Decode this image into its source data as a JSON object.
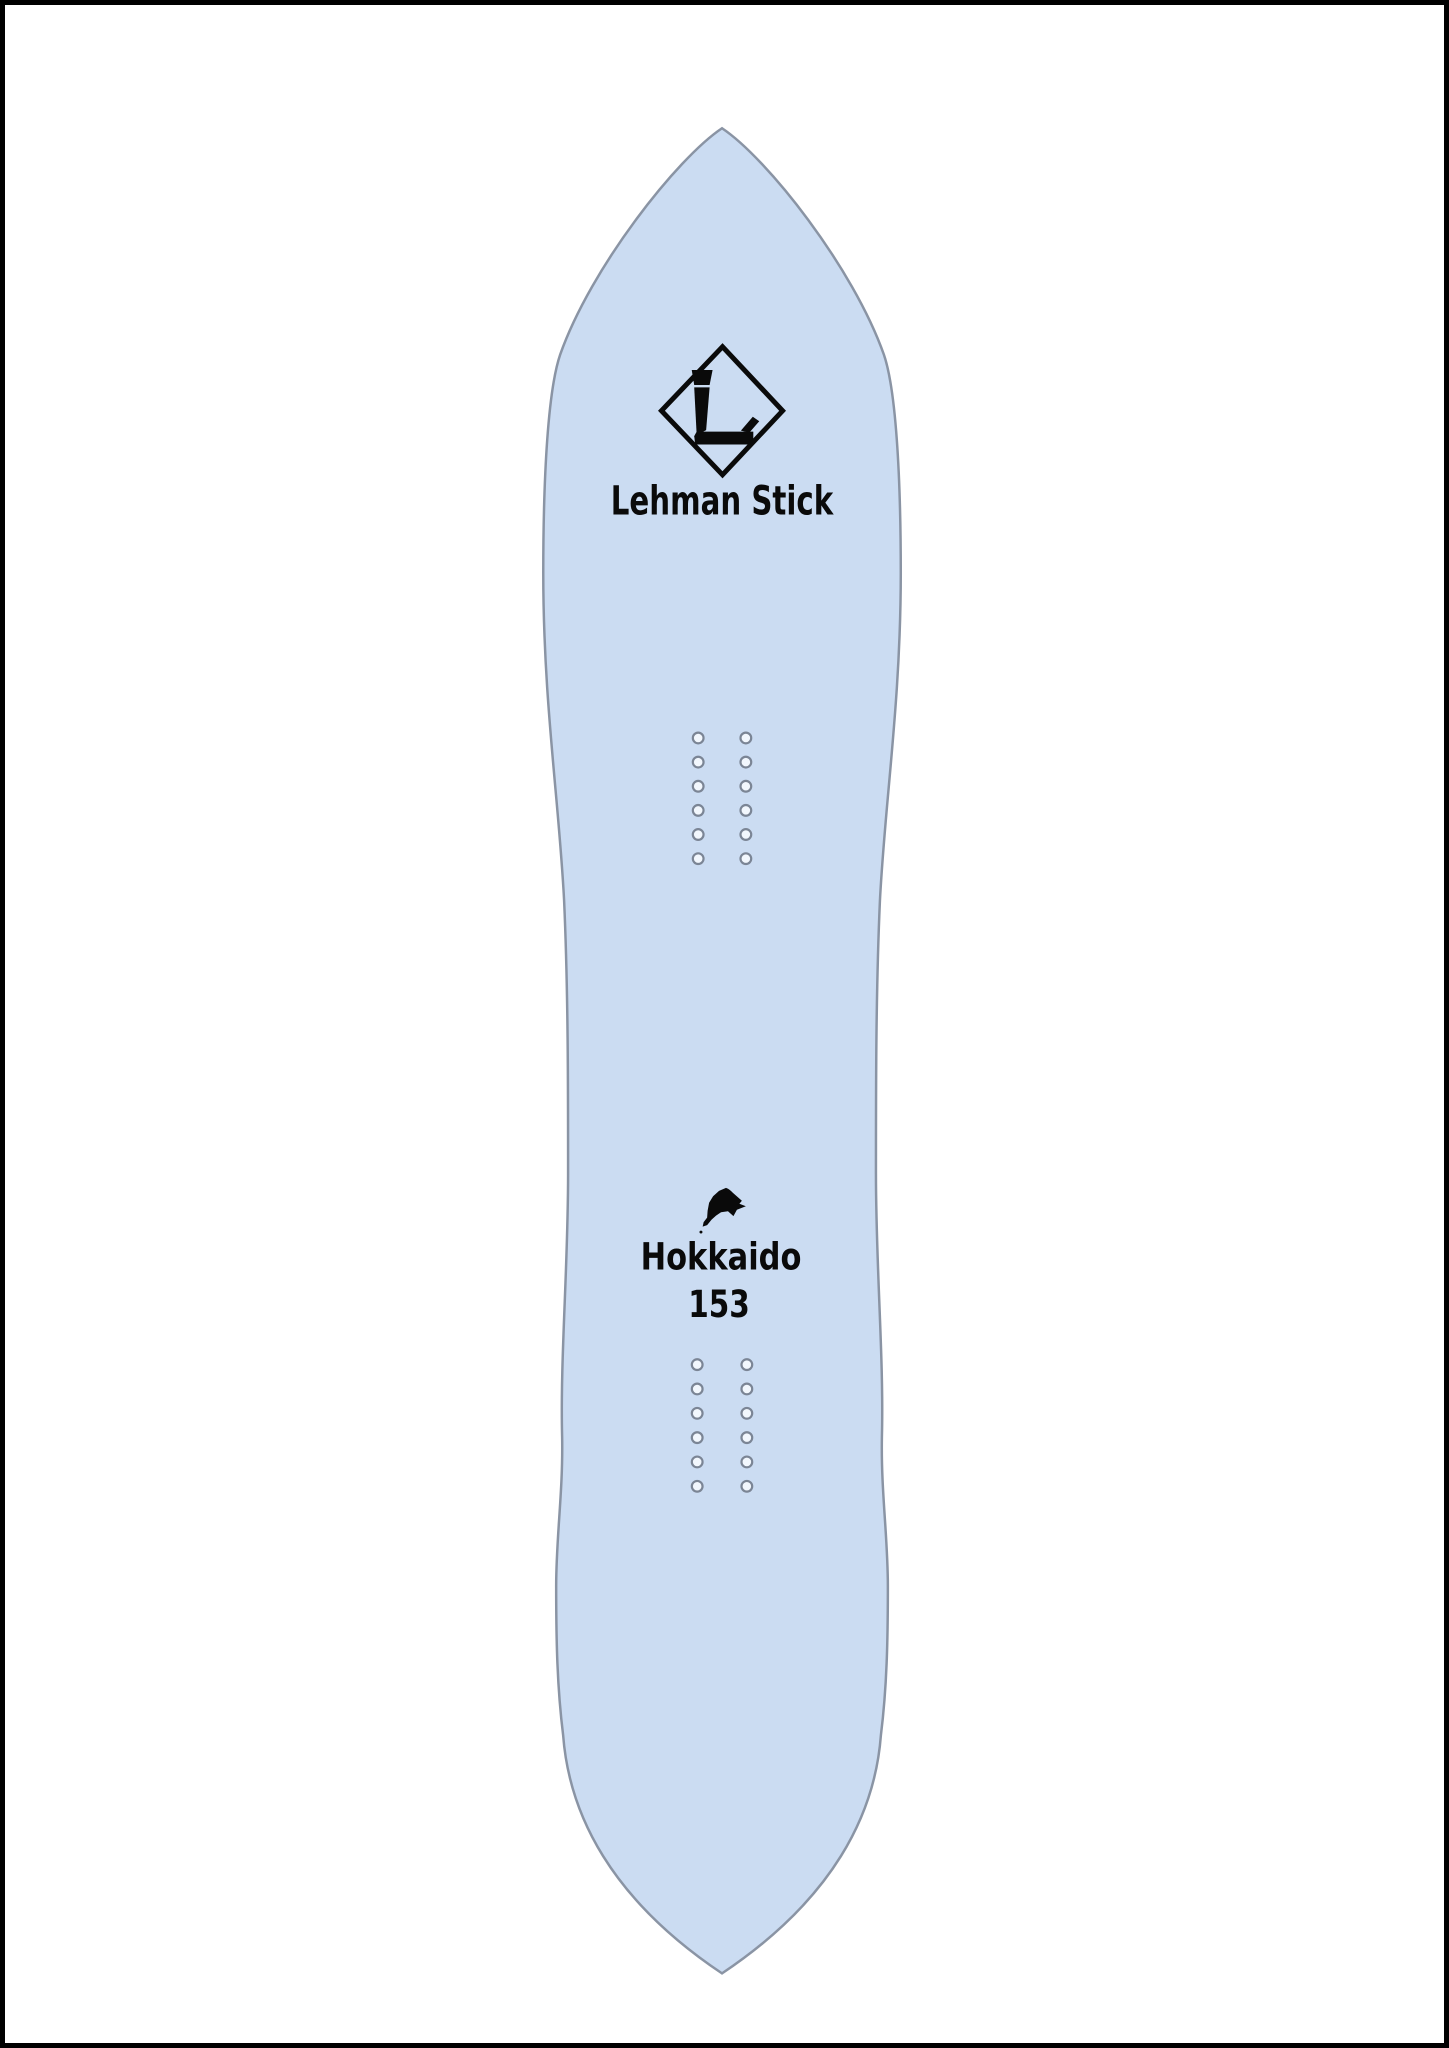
{
  "page": {
    "background_color": "#ffffff",
    "frame_color": "#000000"
  },
  "board": {
    "brand": "Lehman Stick",
    "model": "Hokkaido",
    "length": "153",
    "deck_color": "#cbdcf2",
    "edge_color": "#8a94a4",
    "text_color": "#0a0a0a",
    "logo": {
      "shape": "diamond",
      "letter": "L"
    },
    "icons": {
      "hokkaido_island_icon": "silhouette of Hokkaido island"
    },
    "insert_hole": {
      "radius": 5.4,
      "stroke": "#7b8595",
      "stroke_width": 2.2,
      "fill": "#f2f7fd"
    },
    "insert_groups": [
      {
        "name": "front-inserts",
        "cols": [
          698,
          746
        ],
        "rows": 6,
        "row_start": 736,
        "row_spacing": 24.3
      },
      {
        "name": "rear-inserts",
        "cols": [
          697,
          747
        ],
        "rows": 6,
        "row_start": 1367,
        "row_spacing": 24.5
      }
    ]
  }
}
